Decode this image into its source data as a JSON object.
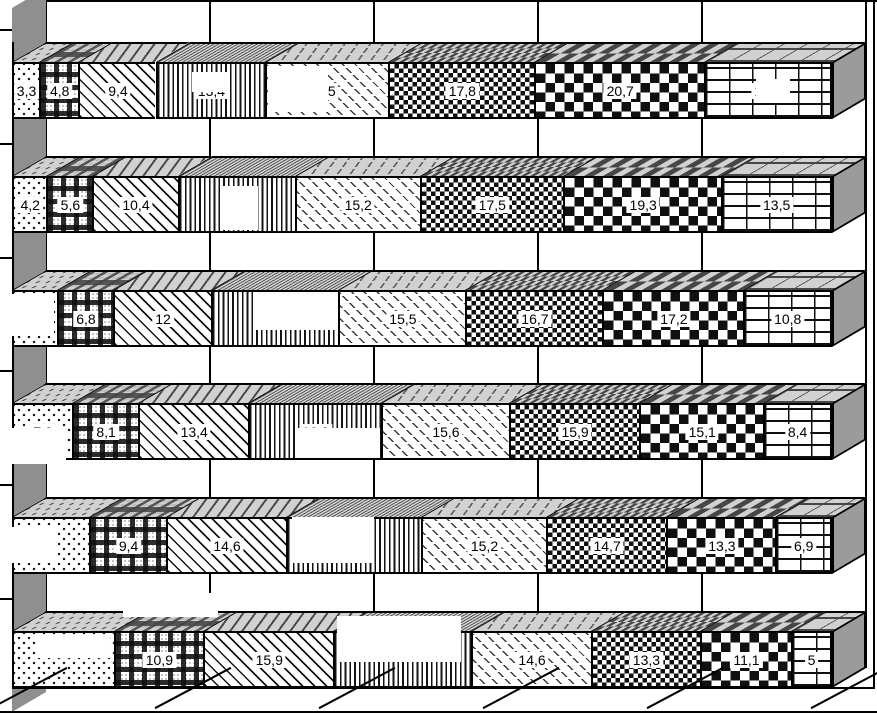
{
  "chart_data": {
    "type": "bar",
    "subtype": "stacked-horizontal-3d",
    "title": "",
    "xlabel": "",
    "ylabel": "",
    "x_axis": {
      "min": 0,
      "max": 100,
      "gridline_step": 20,
      "tick_labels_visible": false,
      "grid": true
    },
    "patterns": [
      "dots",
      "gingham-plaid",
      "diagonal-hatch",
      "vertical-lines",
      "dash-hatch",
      "small-checker",
      "large-checker",
      "brick"
    ],
    "rows": [
      {
        "values": [
          3.3,
          4.8,
          9.4,
          13.4,
          15.0,
          17.8,
          20.7,
          15.6
        ],
        "labels": [
          "3,3",
          "4,8",
          "9,4",
          "13,4",
          "15",
          "17,8",
          "20,7",
          "15,6"
        ]
      },
      {
        "values": [
          4.2,
          5.6,
          10.4,
          14.3,
          15.2,
          17.5,
          19.3,
          13.5
        ],
        "labels": [
          "4,2",
          "5,6",
          "10,4",
          "14,3",
          "15,2",
          "17,5",
          "19,3",
          "13,5"
        ]
      },
      {
        "values": [
          5.5,
          6.8,
          12.0,
          15.5,
          15.5,
          16.7,
          17.2,
          10.8
        ],
        "labels": [
          "",
          "6,8",
          "12",
          "",
          "15,5",
          "16,7",
          "17,2",
          "10,8"
        ]
      },
      {
        "values": [
          7.3,
          8.1,
          13.4,
          16.2,
          15.6,
          15.9,
          15.1,
          8.4
        ],
        "labels": [
          "7,3",
          "8,1",
          "13,4",
          "16,2",
          "15,6",
          "15,9",
          "15,1",
          "8,4"
        ]
      },
      {
        "values": [
          9.4,
          9.4,
          14.6,
          16.5,
          15.2,
          14.7,
          13.3,
          6.9
        ],
        "labels": [
          "",
          "9,4",
          "14,6",
          "",
          "15,2",
          "14,7",
          "13,3",
          "6,9"
        ]
      },
      {
        "values": [
          12.4,
          10.9,
          15.9,
          16.8,
          14.6,
          13.3,
          11.1,
          5.0
        ],
        "labels": [
          "",
          "10,9",
          "15,9",
          "",
          "14,6",
          "13,3",
          "11,1",
          "5"
        ]
      }
    ],
    "redactions": [
      {
        "x": 192,
        "y": 72,
        "w": 36,
        "h": 20
      },
      {
        "x": 268,
        "y": 66,
        "w": 60,
        "h": 46
      },
      {
        "x": 756,
        "y": 79,
        "w": 34,
        "h": 24
      },
      {
        "x": 222,
        "y": 186,
        "w": 36,
        "h": 44
      },
      {
        "x": 4,
        "y": 294,
        "w": 50,
        "h": 42
      },
      {
        "x": 256,
        "y": 292,
        "w": 80,
        "h": 38
      },
      {
        "x": 0,
        "y": 428,
        "w": 66,
        "h": 36
      },
      {
        "x": 298,
        "y": 428,
        "w": 82,
        "h": 30
      },
      {
        "x": 0,
        "y": 527,
        "w": 58,
        "h": 36
      },
      {
        "x": 292,
        "y": 517,
        "w": 82,
        "h": 46
      },
      {
        "x": 123,
        "y": 593,
        "w": 95,
        "h": 24
      },
      {
        "x": 37,
        "y": 636,
        "w": 73,
        "h": 22
      },
      {
        "x": 337,
        "y": 616,
        "w": 124,
        "h": 46
      }
    ],
    "colors": {
      "ink": "#000000",
      "background": "#ffffff",
      "wall_gray": "#8f8f8f",
      "side_gray": "#9b9b9b"
    }
  }
}
